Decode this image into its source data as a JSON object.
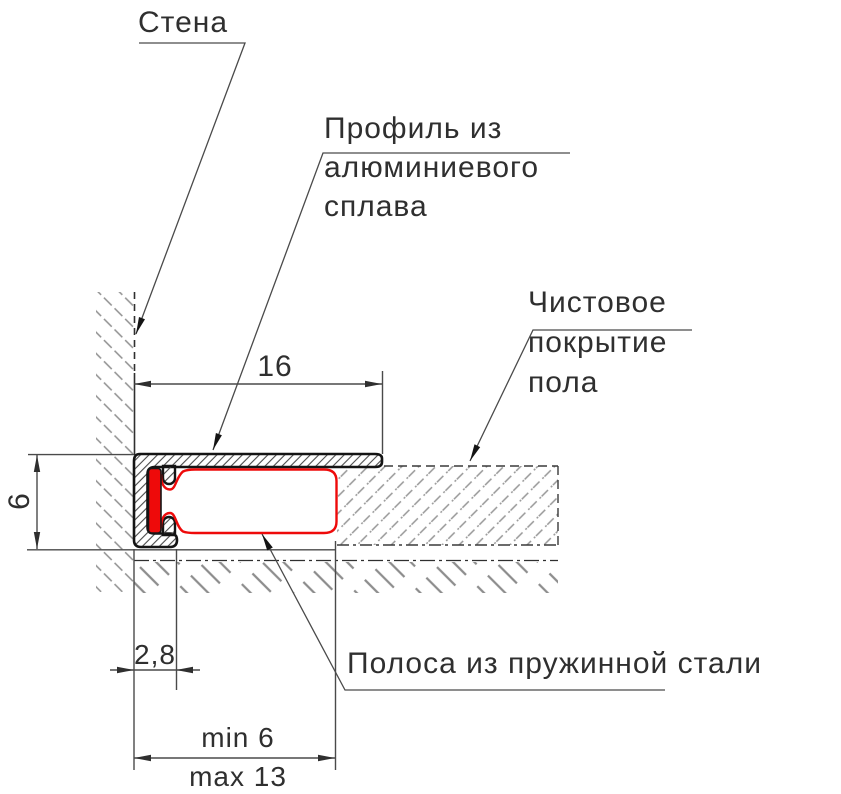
{
  "drawing_type": "floor-profile-cross-section",
  "labels": {
    "wall": "Стена",
    "profile": [
      "Профиль из",
      "алюминиевого",
      "сплава"
    ],
    "floor_finish": [
      "Чистовое",
      "покрытие",
      "пола"
    ],
    "steel_strip": "Полоса из пружинной стали"
  },
  "dimensions": {
    "profile_width": "16",
    "profile_height": "6",
    "strip_offset": "2,8",
    "gap_min": "min 6",
    "gap_max": "max 13"
  },
  "colors": {
    "steel_strip_red": "#ee0a0a",
    "outline_black": "#141414",
    "line_gray": "#4a4a4a",
    "hatch_gray": "#8f8f8f"
  }
}
